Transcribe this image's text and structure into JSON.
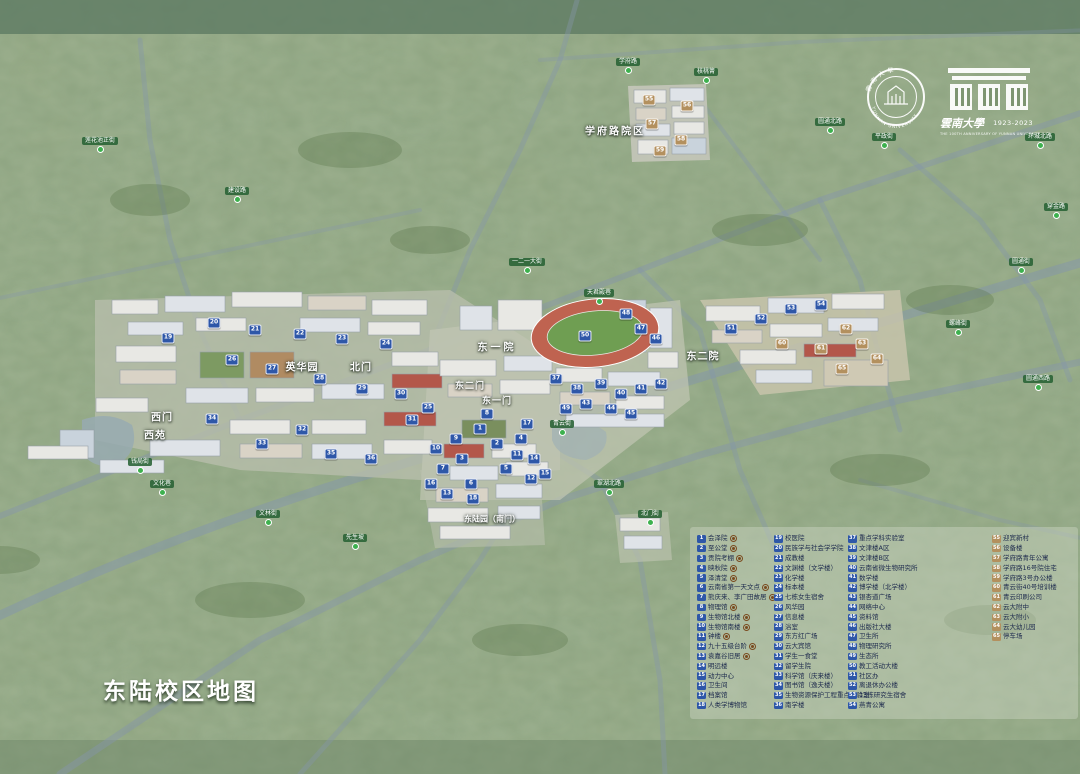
{
  "title": "东陆校区地图",
  "logos": {
    "seal_cn": "雲南大學",
    "seal_en": "YUNNAN UNIVERSITY",
    "seal_year": "1923",
    "centennial_name": "雲南大學",
    "centennial_years": "1923-2023",
    "centennial_sub": "THE 100TH ANNIVERSARY OF YUNNAN UNIVERSITY"
  },
  "colors": {
    "badge_blue": "#2e57a8",
    "badge_tan": "#b3905e",
    "heritage_marker": "#7a4b1f",
    "road_label_green": "#286234",
    "terrain_green": "#8ea37f"
  },
  "map_labels": [
    {
      "t": "学府路院区",
      "x": 615,
      "y": 130,
      "size": 10,
      "ls": 2
    },
    {
      "t": "英华园",
      "x": 302,
      "y": 366,
      "size": 10,
      "ls": 1
    },
    {
      "t": "北门",
      "x": 361,
      "y": 366,
      "size": 10,
      "ls": 1
    },
    {
      "t": "西门",
      "x": 162,
      "y": 416,
      "size": 10,
      "ls": 1
    },
    {
      "t": "西苑",
      "x": 155,
      "y": 434,
      "size": 10,
      "ls": 1
    },
    {
      "t": "东一院",
      "x": 497,
      "y": 346,
      "size": 10,
      "ls": 3
    },
    {
      "t": "东二门",
      "x": 470,
      "y": 385,
      "size": 9,
      "ls": 1
    },
    {
      "t": "东一门",
      "x": 497,
      "y": 400,
      "size": 9,
      "ls": 1
    },
    {
      "t": "东二院",
      "x": 703,
      "y": 355,
      "size": 10,
      "ls": 1
    },
    {
      "t": "东陆园（南门）",
      "x": 492,
      "y": 519,
      "size": 8,
      "ls": 0
    }
  ],
  "road_labels": [
    {
      "t": "学府路",
      "x": 628,
      "y": 74
    },
    {
      "t": "核桃箐",
      "x": 706,
      "y": 84
    },
    {
      "t": "圆通北路",
      "x": 830,
      "y": 134
    },
    {
      "t": "平政街",
      "x": 884,
      "y": 149
    },
    {
      "t": "环城北路",
      "x": 1040,
      "y": 149
    },
    {
      "t": "穿金路",
      "x": 1056,
      "y": 219
    },
    {
      "t": "圆通街",
      "x": 1021,
      "y": 274
    },
    {
      "t": "一二一大街",
      "x": 527,
      "y": 274
    },
    {
      "t": "天君殿巷",
      "x": 599,
      "y": 305
    },
    {
      "t": "莲花池正街",
      "x": 100,
      "y": 153
    },
    {
      "t": "建设路",
      "x": 237,
      "y": 203
    },
    {
      "t": "螺峰街",
      "x": 958,
      "y": 336
    },
    {
      "t": "圆通西路",
      "x": 1038,
      "y": 391
    },
    {
      "t": "钱局街",
      "x": 140,
      "y": 474
    },
    {
      "t": "文化巷",
      "x": 162,
      "y": 496
    },
    {
      "t": "文林街",
      "x": 268,
      "y": 526
    },
    {
      "t": "先生坡",
      "x": 355,
      "y": 550
    },
    {
      "t": "青云街",
      "x": 562,
      "y": 436
    },
    {
      "t": "翠湖北路",
      "x": 609,
      "y": 496
    },
    {
      "t": "北门街",
      "x": 650,
      "y": 526
    }
  ],
  "badges": [
    {
      "n": 19,
      "x": 168,
      "y": 338
    },
    {
      "n": 20,
      "x": 214,
      "y": 323
    },
    {
      "n": 21,
      "x": 255,
      "y": 330
    },
    {
      "n": 22,
      "x": 300,
      "y": 334
    },
    {
      "n": 23,
      "x": 342,
      "y": 339
    },
    {
      "n": 24,
      "x": 386,
      "y": 344
    },
    {
      "n": 25,
      "x": 428,
      "y": 408
    },
    {
      "n": 26,
      "x": 232,
      "y": 360
    },
    {
      "n": 27,
      "x": 272,
      "y": 369
    },
    {
      "n": 28,
      "x": 320,
      "y": 379
    },
    {
      "n": 29,
      "x": 362,
      "y": 389
    },
    {
      "n": 30,
      "x": 401,
      "y": 394
    },
    {
      "n": 31,
      "x": 412,
      "y": 420
    },
    {
      "n": 32,
      "x": 302,
      "y": 430
    },
    {
      "n": 33,
      "x": 262,
      "y": 444
    },
    {
      "n": 34,
      "x": 212,
      "y": 419
    },
    {
      "n": 35,
      "x": 331,
      "y": 454
    },
    {
      "n": 36,
      "x": 371,
      "y": 459
    },
    {
      "n": 1,
      "x": 480,
      "y": 429
    },
    {
      "n": 2,
      "x": 497,
      "y": 444
    },
    {
      "n": 3,
      "x": 462,
      "y": 459
    },
    {
      "n": 4,
      "x": 521,
      "y": 439
    },
    {
      "n": 5,
      "x": 506,
      "y": 469
    },
    {
      "n": 6,
      "x": 471,
      "y": 484
    },
    {
      "n": 7,
      "x": 443,
      "y": 469
    },
    {
      "n": 8,
      "x": 487,
      "y": 414
    },
    {
      "n": 9,
      "x": 456,
      "y": 439
    },
    {
      "n": 10,
      "x": 436,
      "y": 449
    },
    {
      "n": 11,
      "x": 517,
      "y": 455
    },
    {
      "n": 12,
      "x": 531,
      "y": 479
    },
    {
      "n": 13,
      "x": 447,
      "y": 494
    },
    {
      "n": 14,
      "x": 534,
      "y": 459
    },
    {
      "n": 15,
      "x": 545,
      "y": 474
    },
    {
      "n": 16,
      "x": 431,
      "y": 484
    },
    {
      "n": 17,
      "x": 527,
      "y": 424
    },
    {
      "n": 18,
      "x": 473,
      "y": 499
    },
    {
      "n": 37,
      "x": 556,
      "y": 379
    },
    {
      "n": 38,
      "x": 577,
      "y": 389
    },
    {
      "n": 39,
      "x": 601,
      "y": 384
    },
    {
      "n": 40,
      "x": 621,
      "y": 394
    },
    {
      "n": 41,
      "x": 641,
      "y": 389
    },
    {
      "n": 42,
      "x": 661,
      "y": 384
    },
    {
      "n": 43,
      "x": 586,
      "y": 404
    },
    {
      "n": 44,
      "x": 611,
      "y": 409
    },
    {
      "n": 45,
      "x": 631,
      "y": 414
    },
    {
      "n": 46,
      "x": 656,
      "y": 339
    },
    {
      "n": 47,
      "x": 641,
      "y": 329
    },
    {
      "n": 48,
      "x": 626,
      "y": 314
    },
    {
      "n": 49,
      "x": 566,
      "y": 409
    },
    {
      "n": 50,
      "x": 585,
      "y": 336
    },
    {
      "n": 51,
      "x": 731,
      "y": 329
    },
    {
      "n": 52,
      "x": 761,
      "y": 319
    },
    {
      "n": 53,
      "x": 791,
      "y": 309
    },
    {
      "n": 54,
      "x": 821,
      "y": 305
    },
    {
      "n": 55,
      "x": 649,
      "y": 100,
      "c": "t"
    },
    {
      "n": 56,
      "x": 687,
      "y": 106,
      "c": "t"
    },
    {
      "n": 57,
      "x": 652,
      "y": 124,
      "c": "t"
    },
    {
      "n": 58,
      "x": 681,
      "y": 140,
      "c": "t"
    },
    {
      "n": 59,
      "x": 660,
      "y": 151,
      "c": "t"
    },
    {
      "n": 60,
      "x": 782,
      "y": 344,
      "c": "t"
    },
    {
      "n": 61,
      "x": 821,
      "y": 349,
      "c": "t"
    },
    {
      "n": 62,
      "x": 846,
      "y": 329,
      "c": "t"
    },
    {
      "n": 63,
      "x": 862,
      "y": 344,
      "c": "t"
    },
    {
      "n": 64,
      "x": 877,
      "y": 359,
      "c": "t"
    },
    {
      "n": 65,
      "x": 842,
      "y": 369,
      "c": "t"
    }
  ],
  "legend": {
    "col1": [
      {
        "n": 1,
        "label": "会泽院",
        "heritage": true
      },
      {
        "n": 2,
        "label": "至公堂",
        "heritage": true
      },
      {
        "n": 3,
        "label": "贡院考棚",
        "heritage": true
      },
      {
        "n": 4,
        "label": "映秋院",
        "heritage": true
      },
      {
        "n": 5,
        "label": "泽清堂",
        "heritage": true
      },
      {
        "n": 6,
        "label": "云南省第一天文点",
        "heritage": true
      },
      {
        "n": 7,
        "label": "熊庆来、李广田故居",
        "heritage": true
      },
      {
        "n": 8,
        "label": "物理馆",
        "heritage": true
      },
      {
        "n": 9,
        "label": "生物馆北楼",
        "heritage": true
      },
      {
        "n": 10,
        "label": "生物馆南楼",
        "heritage": true
      },
      {
        "n": 11,
        "label": "钟楼",
        "heritage": true
      },
      {
        "n": 12,
        "label": "九十五级台阶",
        "heritage": true
      },
      {
        "n": 13,
        "label": "袁嘉谷旧居",
        "heritage": true
      },
      {
        "n": 14,
        "label": "明远楼"
      },
      {
        "n": 15,
        "label": "动力中心"
      },
      {
        "n": 16,
        "label": "卫生间"
      },
      {
        "n": 17,
        "label": "档案馆"
      },
      {
        "n": 18,
        "label": "人类学博物馆"
      }
    ],
    "col2": [
      {
        "n": 19,
        "label": "校医院"
      },
      {
        "n": 20,
        "label": "民族学与社会学学院"
      },
      {
        "n": 21,
        "label": "成教楼"
      },
      {
        "n": 22,
        "label": "文渊楼（文学楼）"
      },
      {
        "n": 23,
        "label": "化学楼"
      },
      {
        "n": 24,
        "label": "标本楼"
      },
      {
        "n": 25,
        "label": "七栋女生宿舍"
      },
      {
        "n": 26,
        "label": "风华园"
      },
      {
        "n": 27,
        "label": "信息楼"
      },
      {
        "n": 28,
        "label": "浴室"
      },
      {
        "n": 29,
        "label": "东方红广场"
      },
      {
        "n": 30,
        "label": "云大宾馆"
      },
      {
        "n": 31,
        "label": "学生一食堂"
      },
      {
        "n": 32,
        "label": "留学生院"
      },
      {
        "n": 33,
        "label": "科学馆（庆来楼）"
      },
      {
        "n": 34,
        "label": "图书馆（逸夫楼）"
      },
      {
        "n": 35,
        "label": "生物资源保护工程重点实验室"
      },
      {
        "n": 36,
        "label": "南学楼"
      }
    ],
    "col3": [
      {
        "n": 37,
        "label": "重点学科实验室"
      },
      {
        "n": 38,
        "label": "文津楼A区"
      },
      {
        "n": 39,
        "label": "文津楼B区"
      },
      {
        "n": 40,
        "label": "云南省微生物研究所"
      },
      {
        "n": 41,
        "label": "数学楼"
      },
      {
        "n": 42,
        "label": "博学楼（北学楼）"
      },
      {
        "n": 43,
        "label": "银杏道广场"
      },
      {
        "n": 44,
        "label": "网络中心"
      },
      {
        "n": 45,
        "label": "资料馆"
      },
      {
        "n": 46,
        "label": "出版社大楼"
      },
      {
        "n": 47,
        "label": "卫生所"
      },
      {
        "n": 48,
        "label": "物理研究所"
      },
      {
        "n": 49,
        "label": "生态所"
      },
      {
        "n": 50,
        "label": "教工活动大楼"
      },
      {
        "n": 51,
        "label": "社区办"
      },
      {
        "n": 52,
        "label": "离退休办公楼"
      },
      {
        "n": 53,
        "label": "13栋研究生宿舍"
      },
      {
        "n": 54,
        "label": "燕青公寓"
      }
    ],
    "col4": [
      {
        "n": 55,
        "label": "迎宾新村",
        "c": "t"
      },
      {
        "n": 56,
        "label": "设备楼",
        "c": "t"
      },
      {
        "n": 57,
        "label": "学府路青年公寓",
        "c": "t"
      },
      {
        "n": 58,
        "label": "学府路16号院住宅",
        "c": "t"
      },
      {
        "n": 59,
        "label": "学府路3号办公楼",
        "c": "t"
      },
      {
        "n": 60,
        "label": "青云街40号培训楼",
        "c": "t"
      },
      {
        "n": 61,
        "label": "青云印刷公司",
        "c": "t"
      },
      {
        "n": 62,
        "label": "云大附中",
        "c": "t"
      },
      {
        "n": 63,
        "label": "云大附小",
        "c": "t"
      },
      {
        "n": 64,
        "label": "云大幼儿园",
        "c": "t"
      },
      {
        "n": 65,
        "label": "停车场",
        "c": "t"
      }
    ]
  }
}
